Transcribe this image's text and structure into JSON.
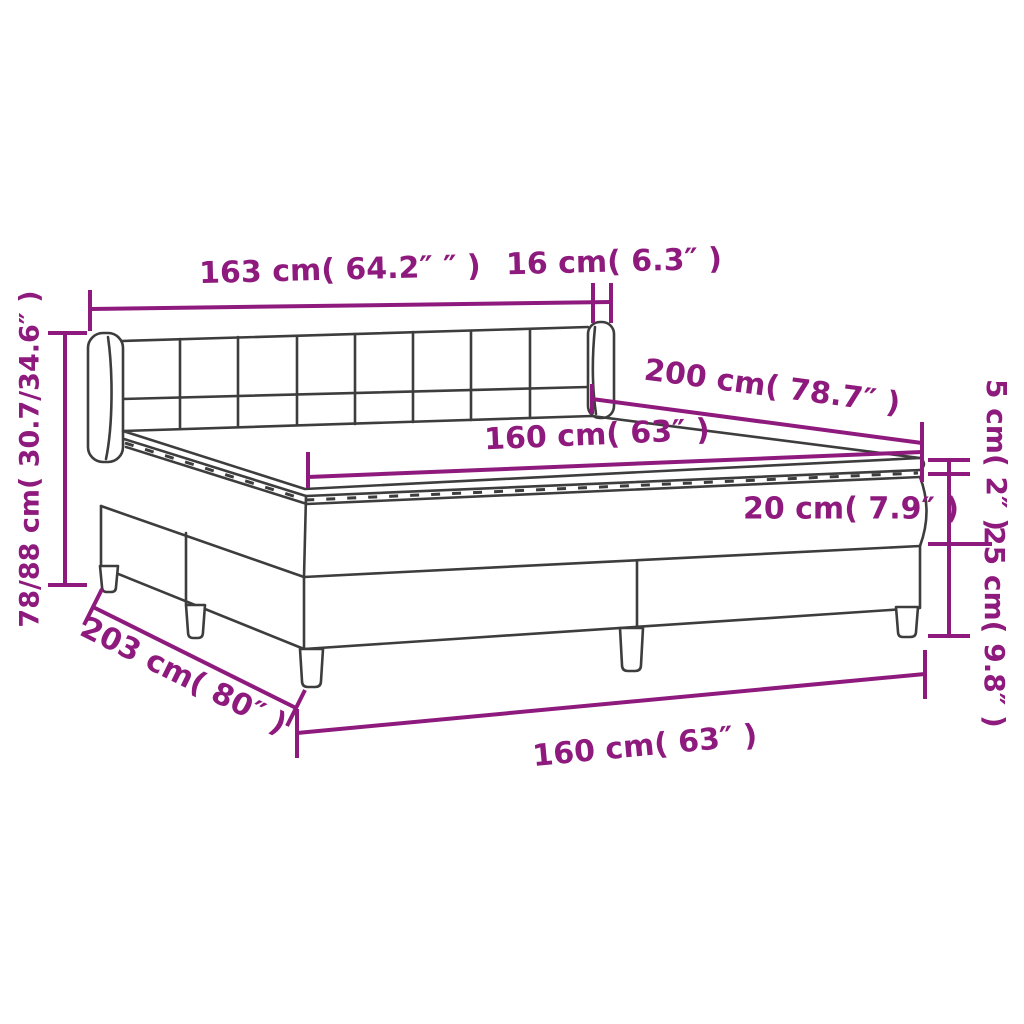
{
  "diagram": {
    "type": "product-dimension-diagram",
    "subject": "box spring bed with tufted headboard, mattress and topper"
  },
  "colors": {
    "dimension": "#8e1a7e",
    "outline": "#3d3d3d",
    "background": "#ffffff"
  },
  "dims": {
    "headboard_width": "163 cm( 64.2″ ″ )",
    "headboard_depth": "16 cm( 6.3″ )",
    "bed_length": "200 cm( 78.7″ )",
    "mattress_width": "160 cm( 63″ )",
    "topper_height": "5 cm( 2″ )",
    "mattress_height": "20 cm( 7.9″ )",
    "base_height": "25 cm( 9.8″ )",
    "total_height": "78/88 cm( 30.7/34.6″ )",
    "base_length": "203 cm( 80″ )",
    "base_width": "160 cm( 63″ )"
  }
}
